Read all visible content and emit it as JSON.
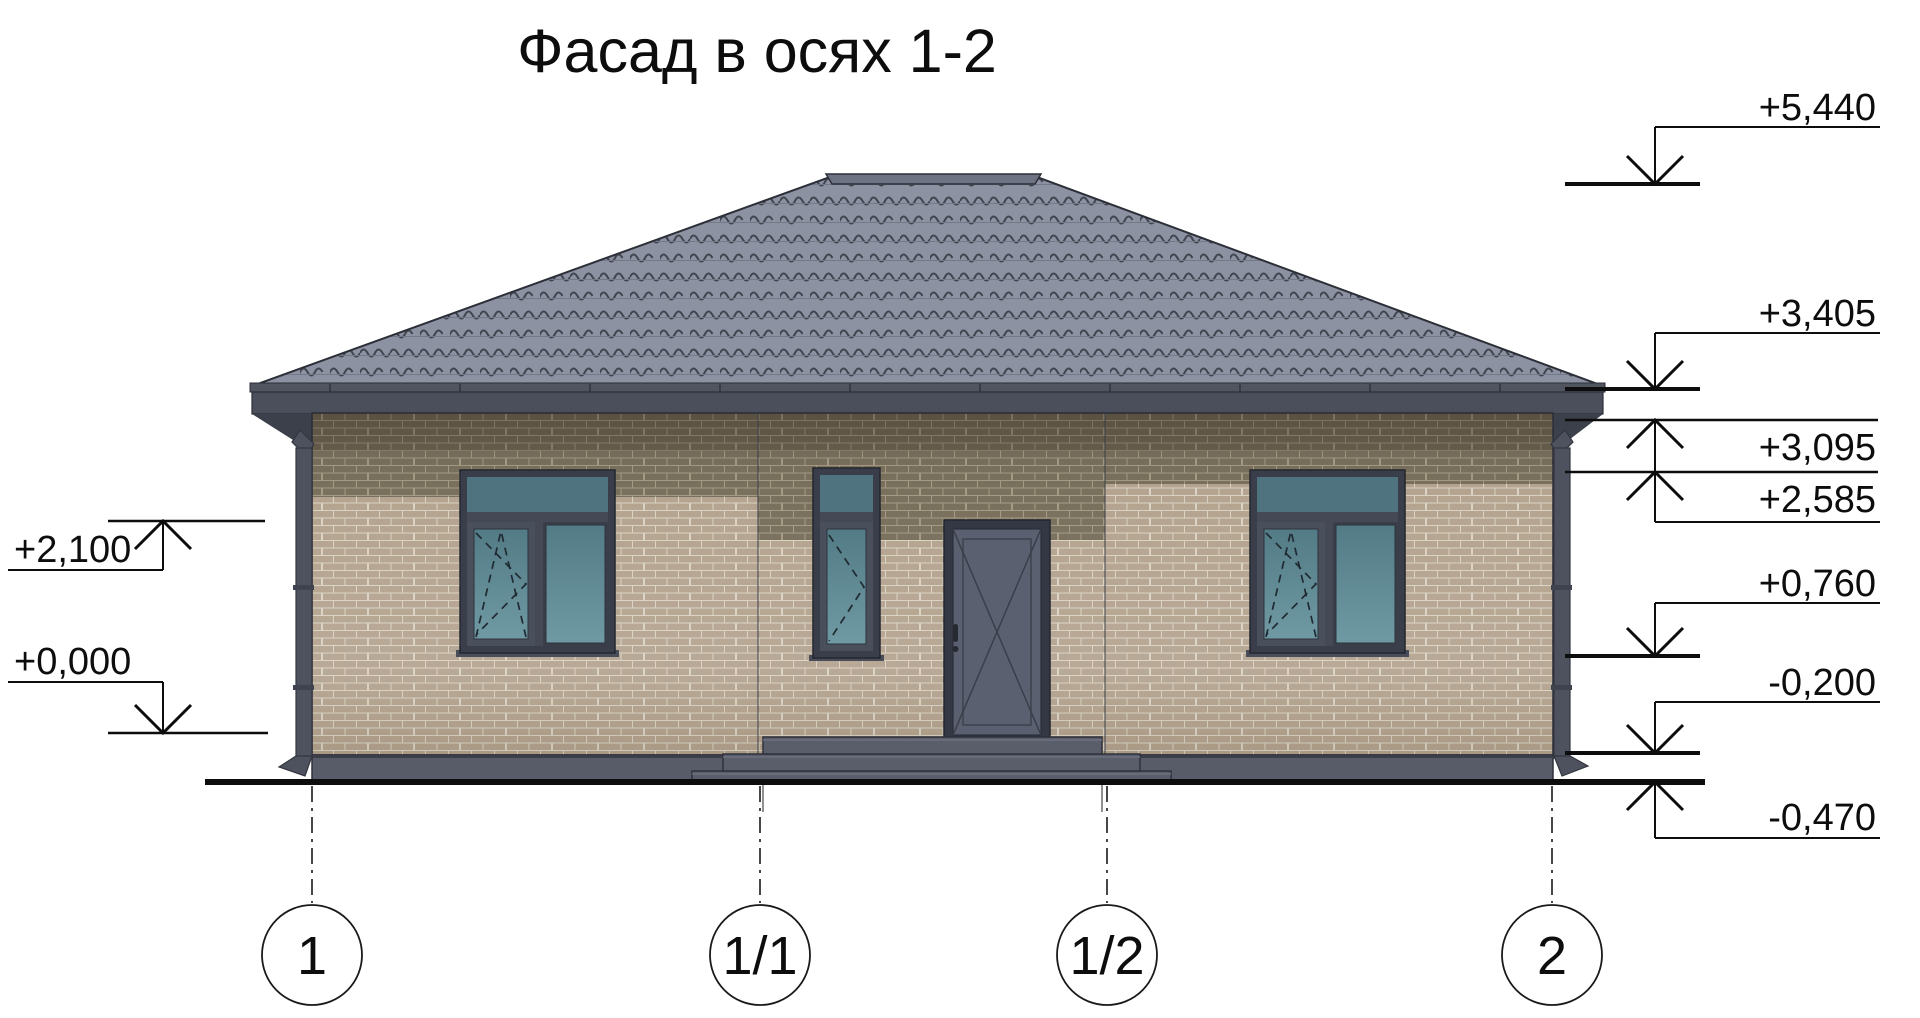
{
  "title": "Фасад в осях 1-2",
  "axes": {
    "items": [
      {
        "label": "1"
      },
      {
        "label": "1/1"
      },
      {
        "label": "1/2"
      },
      {
        "label": "2"
      }
    ]
  },
  "elevations": {
    "left": [
      {
        "label": "+2,100"
      },
      {
        "label": "+0,000"
      }
    ],
    "right": [
      {
        "label": "+5,440"
      },
      {
        "label": "+3,405"
      },
      {
        "label": "+3,095"
      },
      {
        "label": "+2,585"
      },
      {
        "label": "+0,760"
      },
      {
        "label": "-0,200"
      },
      {
        "label": "-0,470"
      }
    ]
  },
  "colors": {
    "roof_tile": "#8d92a2",
    "roof_wave": "#41454f",
    "roof_row": "#747988",
    "fascia": "#4b4f5b",
    "gutter": "#505560",
    "soffit": "#3c404b",
    "brick_light": "#b1a08b",
    "mortar_light": "#d9d1c1",
    "brick_dark": "#746a57",
    "mortar_dark": "#a2977f",
    "plinth": "#585c68",
    "step": "#5a5e6b",
    "frame": "#3a3e4a",
    "sash": "#4a4f5c",
    "glass_top": "#527b86",
    "glass_bottom": "#6f99a3",
    "door_leaf": "#5a6070",
    "pipe": "#4e525e"
  }
}
